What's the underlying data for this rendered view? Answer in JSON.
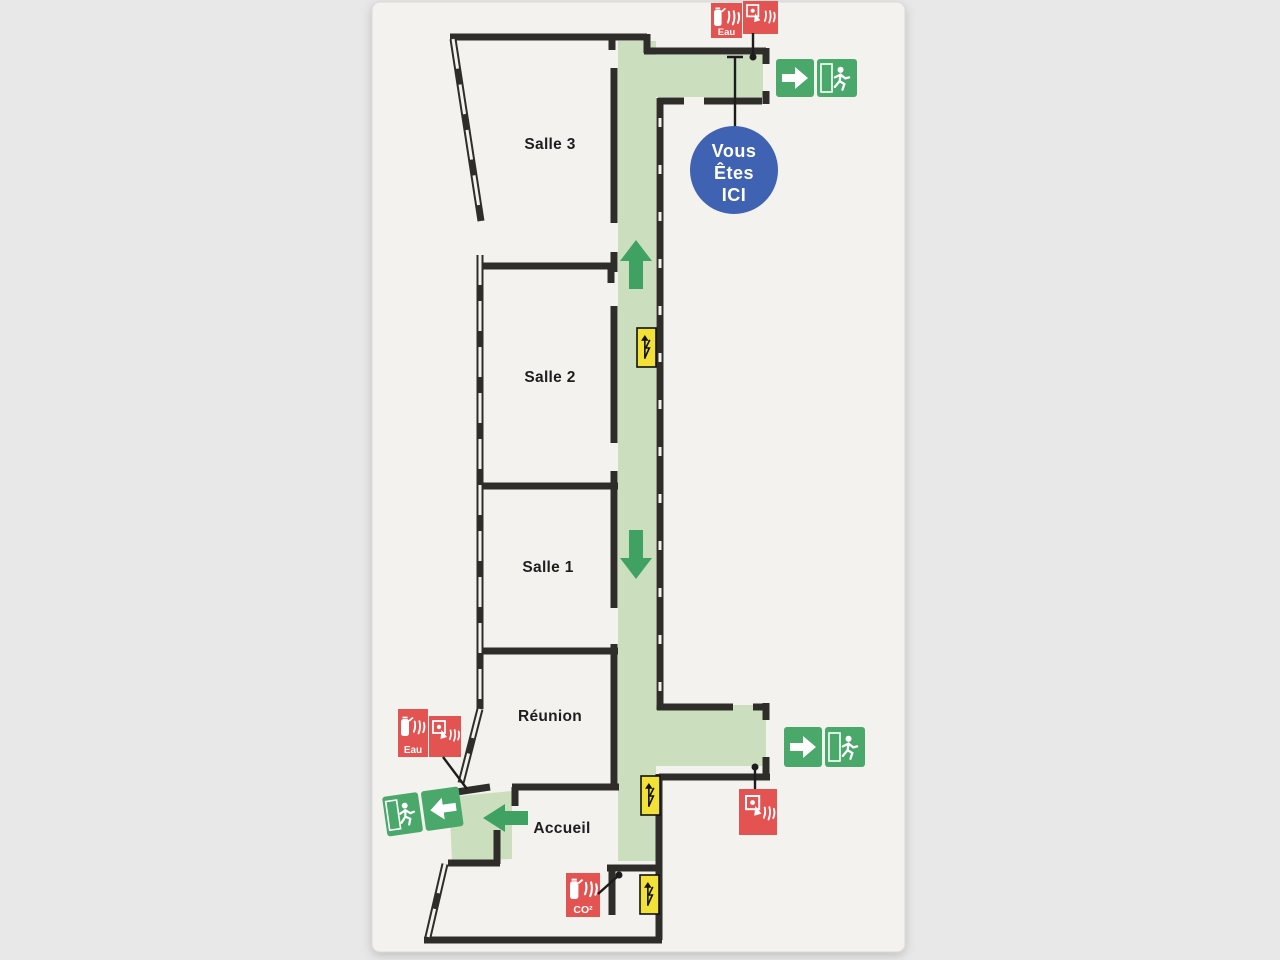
{
  "sign": {
    "type": "evacuation-floor-plan",
    "rooms": {
      "salle3": "Salle 3",
      "salle2": "Salle 2",
      "salle1": "Salle 1",
      "reunion": "Réunion",
      "accueil": "Accueil"
    },
    "you_are_here": {
      "line1": "Vous",
      "line2": "Êtes",
      "line3": "ICI"
    },
    "extinguishers": {
      "water_label": "Eau",
      "co2_label": "CO²"
    },
    "icons": {
      "exit_sign": "running-man-with-arrow",
      "direction_arrow": "solid-green-arrow",
      "fire_extinguisher_water": "extinguisher-with-flames-Eau",
      "fire_extinguisher_co2": "extinguisher-with-flames-CO2",
      "manual_call_point": "hand-pressing-alarm-with-flames",
      "electrical_panel": "up-arrow-with-lightning-bolt",
      "you_are_here_badge": "blue-circle"
    },
    "colors": {
      "page_bg": "#e8e8e8",
      "panel_bg": "#f4f2ee",
      "wall_black": "#2e2d2a",
      "corridor_green": "#cbdfbe",
      "arrow_green": "#3fa263",
      "exit_sign_green": "#4aa86b",
      "alarm_red": "#e25351",
      "electrical_yellow": "#f2e238",
      "you_are_here_blue": "#3f62b2"
    }
  }
}
